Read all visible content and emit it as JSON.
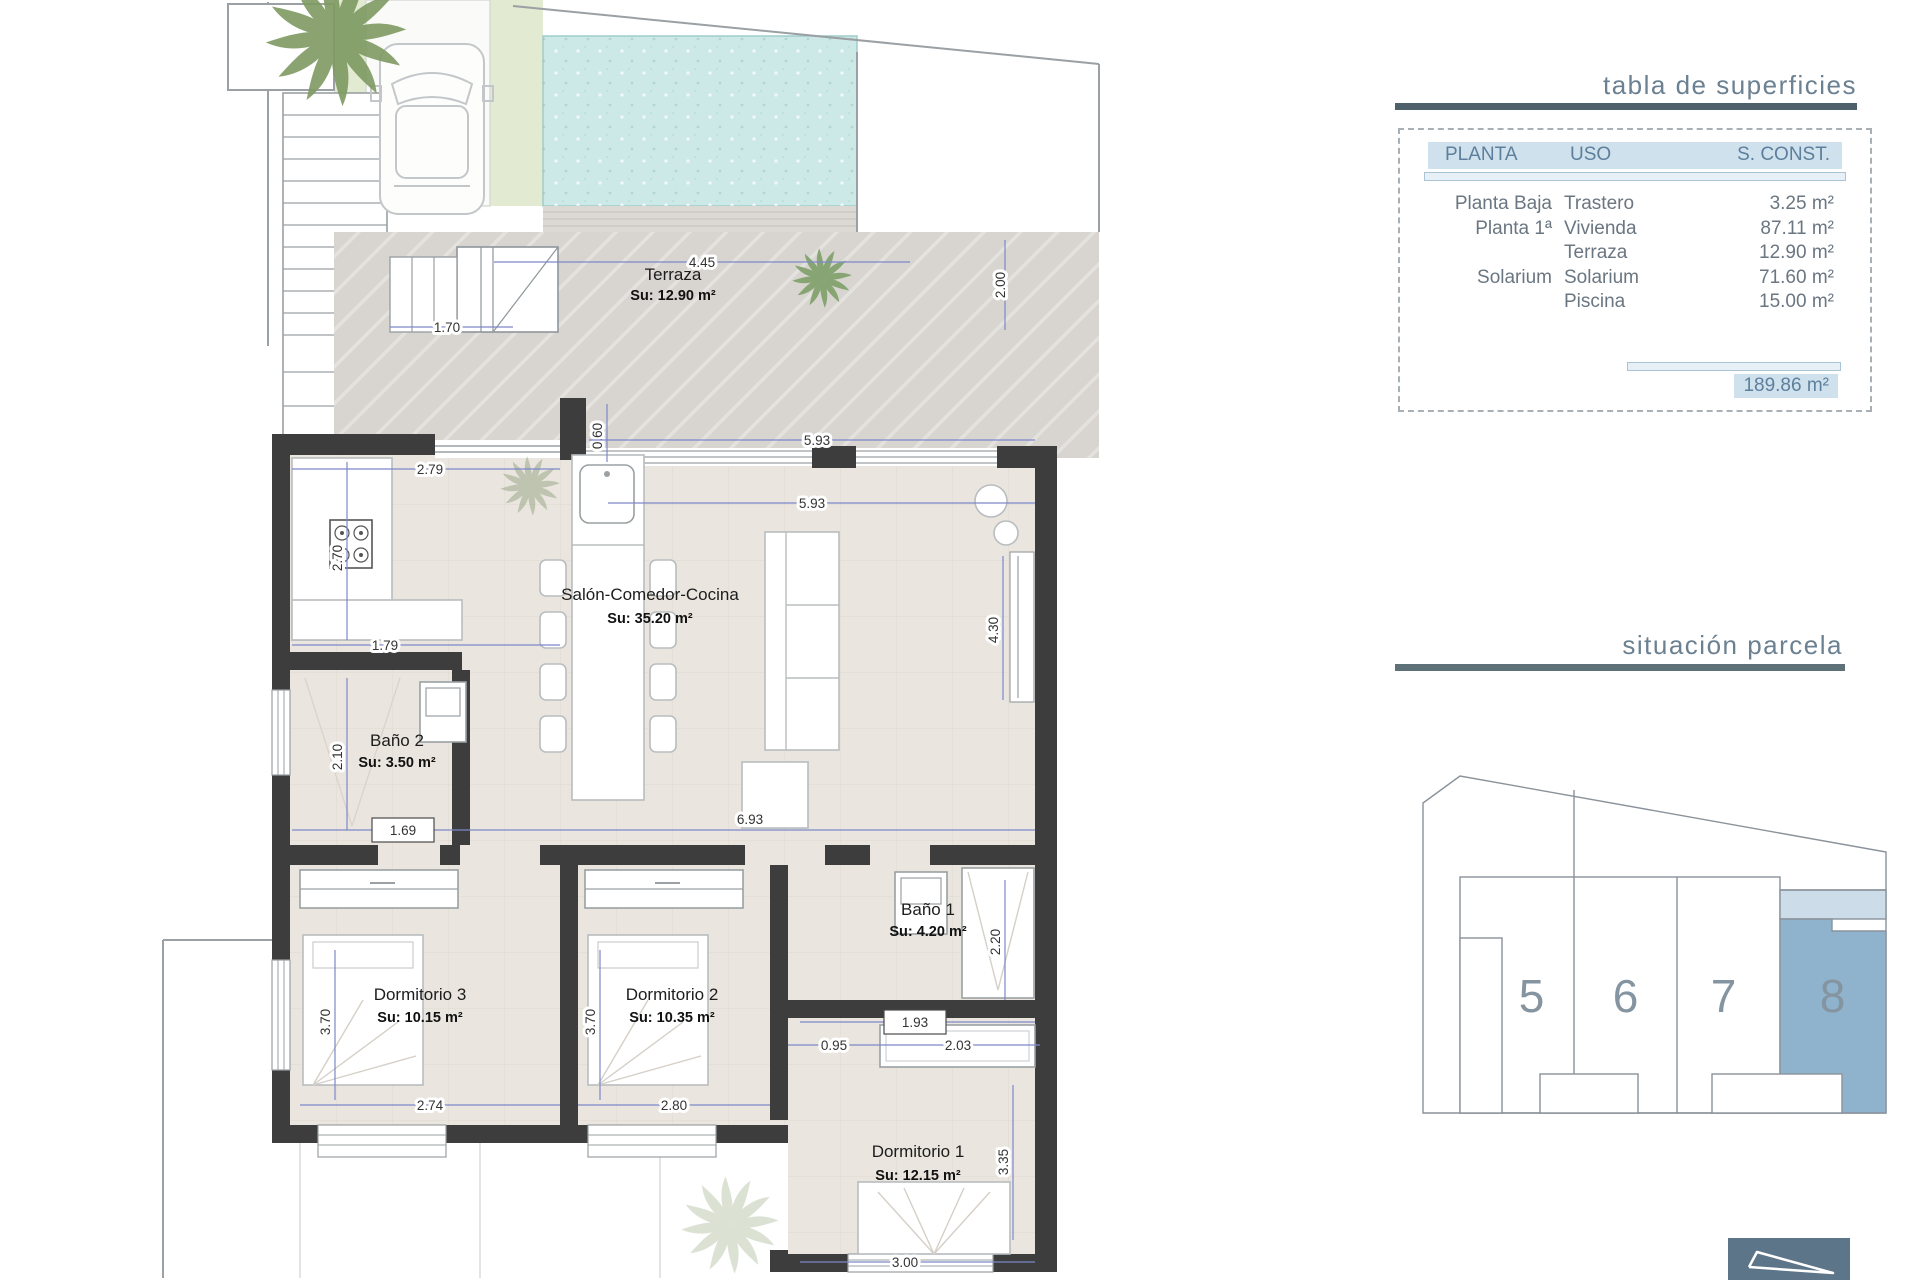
{
  "surfaces_table": {
    "title": "tabla de superficies",
    "col_planta": "PLANTA",
    "col_uso": "USO",
    "col_sconst": "S. CONST.",
    "rows": [
      {
        "planta": "Planta Baja",
        "uso": "Trastero",
        "sconst": "3.25 m²"
      },
      {
        "planta": "Planta 1ª",
        "uso": "Vivienda",
        "sconst": "87.11 m²"
      },
      {
        "planta": "",
        "uso": "Terraza",
        "sconst": "12.90 m²"
      },
      {
        "planta": "Solarium",
        "uso": "Solarium",
        "sconst": "71.60 m²"
      },
      {
        "planta": "",
        "uso": "Piscina",
        "sconst": "15.00 m²"
      }
    ],
    "total": "189.86 m²"
  },
  "parcela": {
    "title": "situación parcela",
    "units": [
      "5",
      "6",
      "7",
      "8"
    ],
    "highlighted_unit": "8"
  },
  "plan": {
    "rooms": {
      "terraza": {
        "name": "Terraza",
        "area": "Su: 12.90 m²"
      },
      "salon": {
        "name": "Salón-Comedor-Cocina",
        "area": "Su: 35.20 m²"
      },
      "bano2": {
        "name": "Baño 2",
        "area": "Su: 3.50 m²"
      },
      "dorm3": {
        "name": "Dormitorio 3",
        "area": "Su: 10.15 m²"
      },
      "dorm2": {
        "name": "Dormitorio 2",
        "area": "Su: 10.35 m²"
      },
      "bano1": {
        "name": "Baño 1",
        "area": "Su: 4.20 m²"
      },
      "dorm1": {
        "name": "Dormitorio 1",
        "area": "Su: 12.15 m²"
      }
    },
    "dims": {
      "d445": "4.45",
      "d200": "2.00",
      "d170": "1.70",
      "d060": "0.60",
      "d279": "2.79",
      "d593a": "5.93",
      "d593b": "5.93",
      "d270": "2.70",
      "d179": "1.79",
      "d430": "4.30",
      "d210": "2.10",
      "d169": "1.69",
      "d693": "6.93",
      "d370a": "3.70",
      "d370b": "3.70",
      "d220": "2.20",
      "d193": "1.93",
      "d095": "0.95",
      "d203": "2.03",
      "d274": "2.74",
      "d280": "2.80",
      "d335": "3.35",
      "d300": "3.00"
    }
  },
  "colors": {
    "accent_teal": "#4e616b",
    "table_header_bg": "#cfe1ed",
    "unit_highlight": "#8fb3cc",
    "unit_highlight_light": "#ccdde9",
    "dim_blue": "#7d88c9",
    "pool": "#cde9e7",
    "wall": "#3d3d3d",
    "north_box": "#5d7588"
  }
}
